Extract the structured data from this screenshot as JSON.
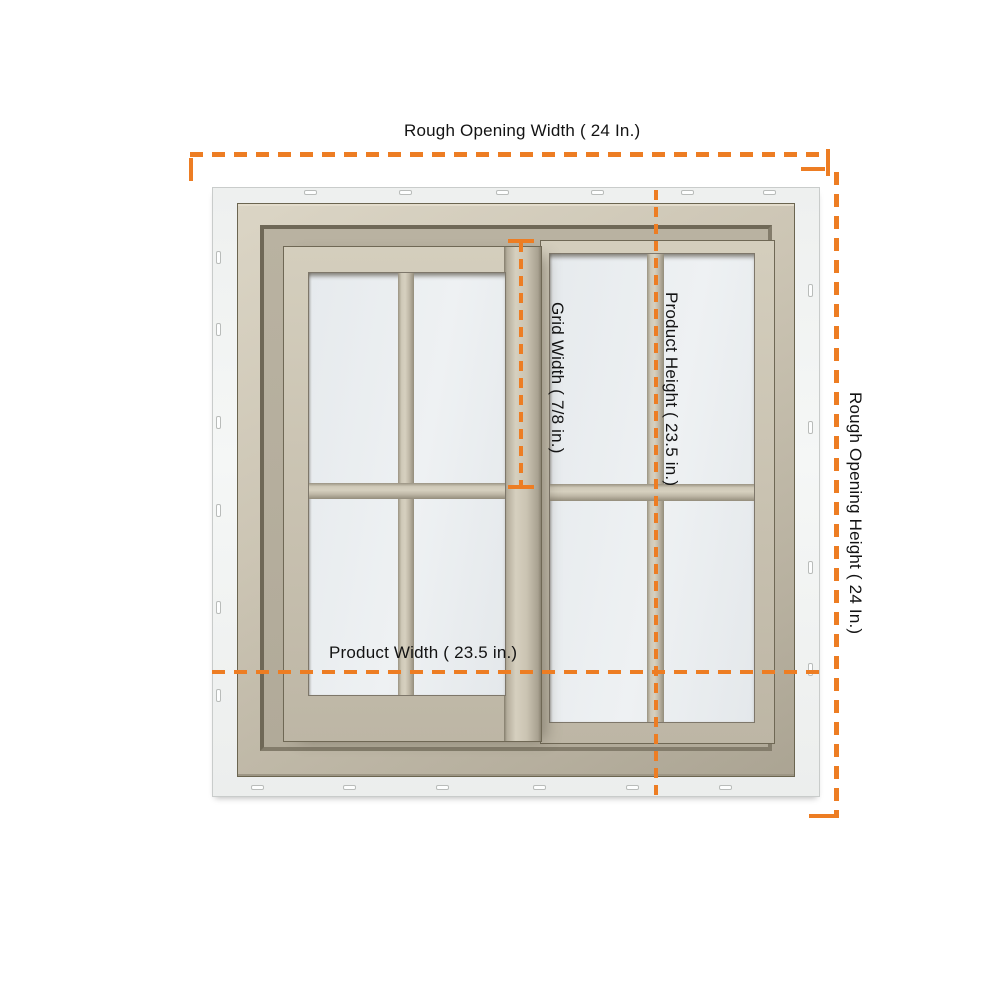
{
  "page": {
    "background_color": "#ffffff",
    "description": "Product dimension diagram of a tan vinyl 2-lite sliding window with colonial grids (2x2 per sash) and orange dashed dimension lines"
  },
  "accent": {
    "dimension_line_color": "#ED7D23",
    "label_text_color": "#131313"
  },
  "window": {
    "style": "horizontal sliding window, two sashes, colonial grille 2x2 per sash, nailing fin",
    "colors": {
      "frame_tan_light": "#d6d0bf",
      "frame_tan_mid": "#c8c1b0",
      "frame_tan_dark": "#9a9382",
      "frame_outline": "#6b6550",
      "glass": "#ebeef1",
      "nailing_fin": "#f3f5f4"
    }
  },
  "dimensions": {
    "rough_opening_width": {
      "label": "Rough Opening Width ( 24 In.)"
    },
    "rough_opening_height": {
      "label": "Rough Opening Height ( 24 In.)"
    },
    "product_width": {
      "label": "Product Width ( 23.5 in.)"
    },
    "product_height": {
      "label": "Product Height ( 23.5 in.)"
    },
    "grid_width": {
      "label": "Grid Width ( 7/8 in.)"
    }
  }
}
